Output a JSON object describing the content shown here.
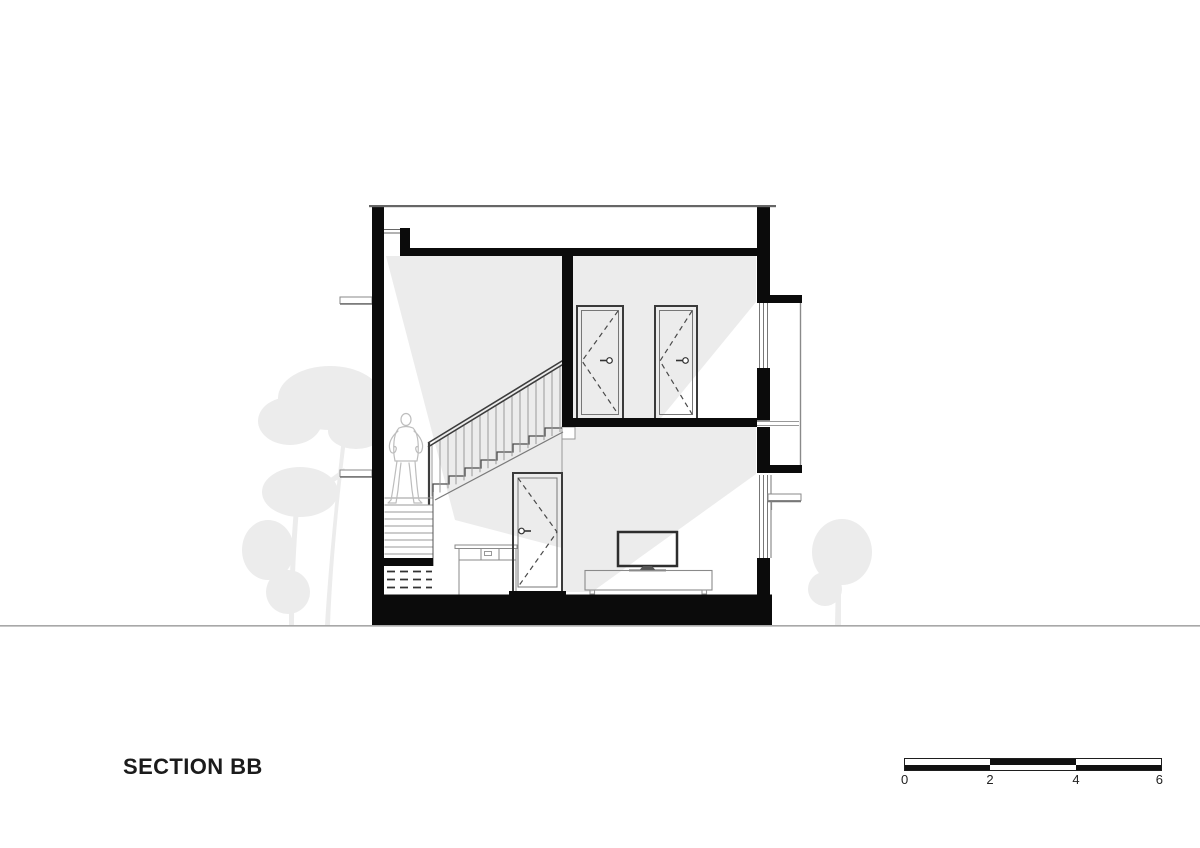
{
  "drawing": {
    "title": "SECTION BB"
  },
  "scale_bar": {
    "tick_labels": [
      "0",
      "2",
      "4",
      "6"
    ]
  },
  "colors": {
    "ink": "#0B0B0B",
    "detail_line": "#4A4A4A",
    "light_shade": "#ECECEC",
    "vegetation": "#ECECEC",
    "ground_line": "#A8A8A8",
    "figure_outline": "#BDBDBD"
  }
}
